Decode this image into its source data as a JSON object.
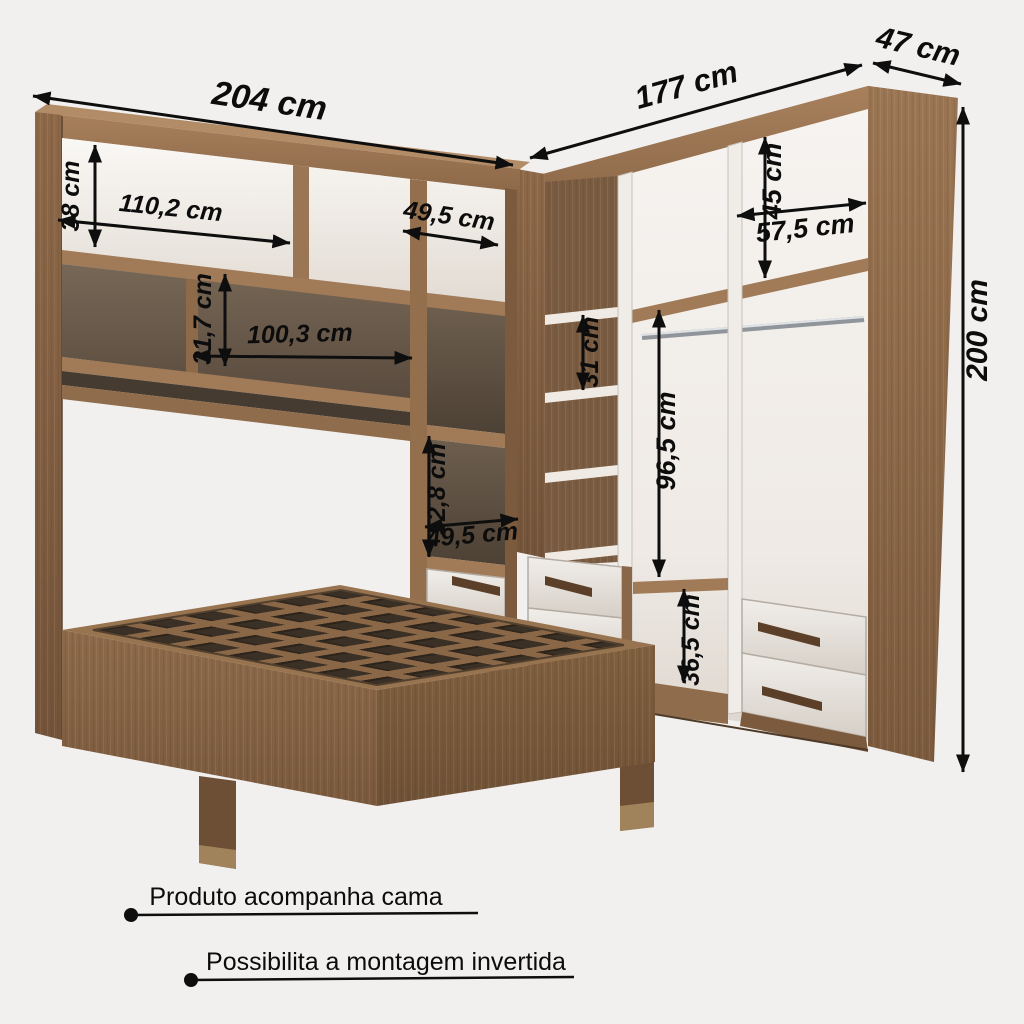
{
  "diagram": {
    "type": "furniture-dimension-diagram",
    "units": "cm",
    "dimensions": [
      {
        "id": "left-wardrobe-width",
        "label": "204 cm"
      },
      {
        "id": "right-wardrobe-width",
        "label": "177 cm"
      },
      {
        "id": "right-wardrobe-depth",
        "label": "47 cm"
      },
      {
        "id": "wardrobe-height",
        "label": "200 cm"
      },
      {
        "id": "top-cubby-height",
        "label": "38 cm"
      },
      {
        "id": "top-cubby-width",
        "label": "110,2 cm"
      },
      {
        "id": "top-right-cubby-width",
        "label": "49,5 cm"
      },
      {
        "id": "mid-shelf-height",
        "label": "31,7 cm"
      },
      {
        "id": "mid-shelf-width",
        "label": "100,3 cm"
      },
      {
        "id": "column-compartment-height",
        "label": "52,8 cm"
      },
      {
        "id": "column-compartment-width",
        "label": "49,5 cm"
      },
      {
        "id": "upper-right-compartment-height",
        "label": "45 cm"
      },
      {
        "id": "upper-right-compartment-width",
        "label": "57,5 cm"
      },
      {
        "id": "corner-shelf-spacing",
        "label": "31 cm"
      },
      {
        "id": "hanging-space-height",
        "label": "96,5 cm"
      },
      {
        "id": "lower-compartment-height",
        "label": "36,5 cm"
      }
    ],
    "notes": [
      {
        "text": "Produto acompanha cama"
      },
      {
        "text": "Possibilita a montagem invertida"
      }
    ],
    "colors": {
      "background": "#f2f0ee",
      "wood_light": "#b28c66",
      "wood_front": "#9a7554",
      "wood_dark": "#6e5037",
      "interior_white": "#f5f2ee",
      "interior_dark": "#6b5c4c",
      "slat_hole": "#3b3025",
      "handle": "#5c3f28",
      "annotation": "#0c0c0c"
    }
  }
}
